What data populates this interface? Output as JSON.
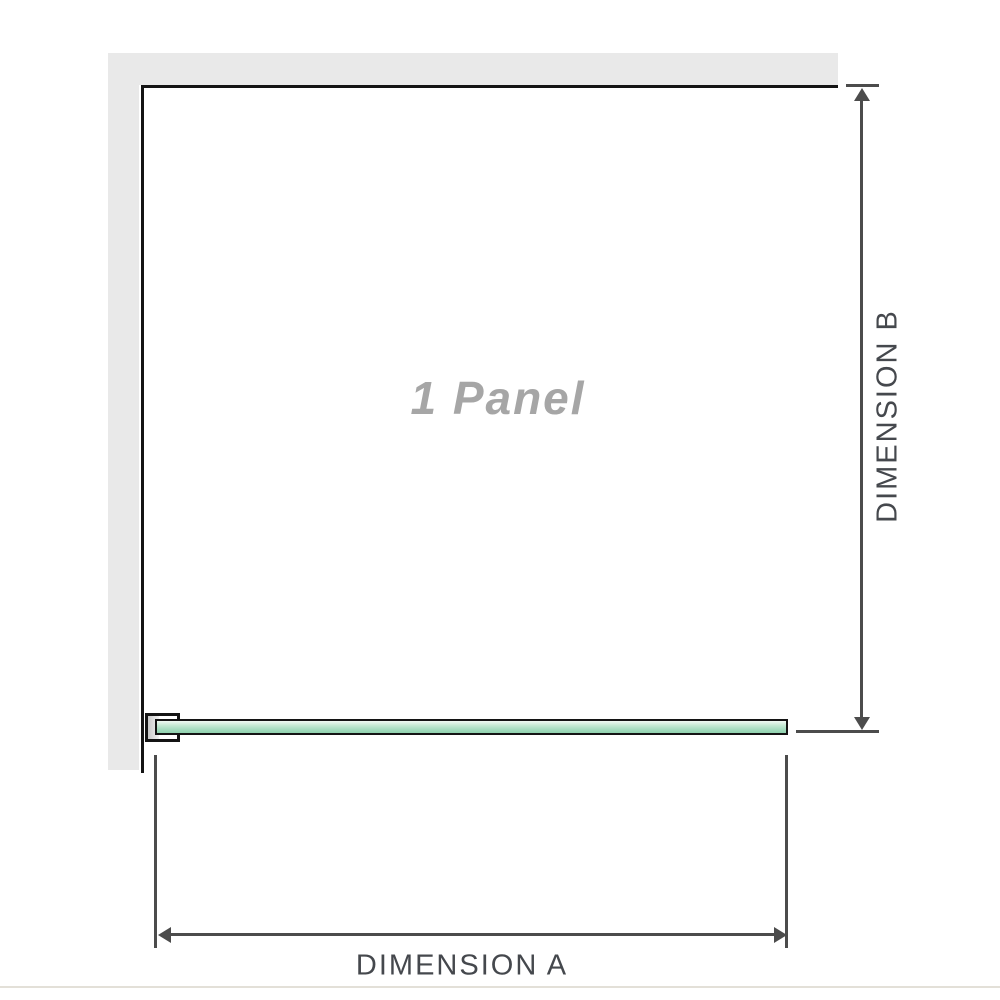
{
  "diagram": {
    "panel_label": "1 Panel",
    "dimensions": {
      "a_label": "DIMENSION A",
      "b_label": "DIMENSION B"
    },
    "colors": {
      "wall": "#e9e9e9",
      "outline": "#141414",
      "glass_gradient_top": "#f1faf4",
      "glass_gradient_mid": "#c7ead5",
      "glass_gradient_mid2": "#a5dcbf",
      "glass_gradient_bottom": "#90d1ae",
      "dimension_line": "#4c4c4c",
      "dimension_text": "#45484d",
      "panel_label_text": "#a6a6a6",
      "baseline": "#e3e0d8"
    }
  }
}
